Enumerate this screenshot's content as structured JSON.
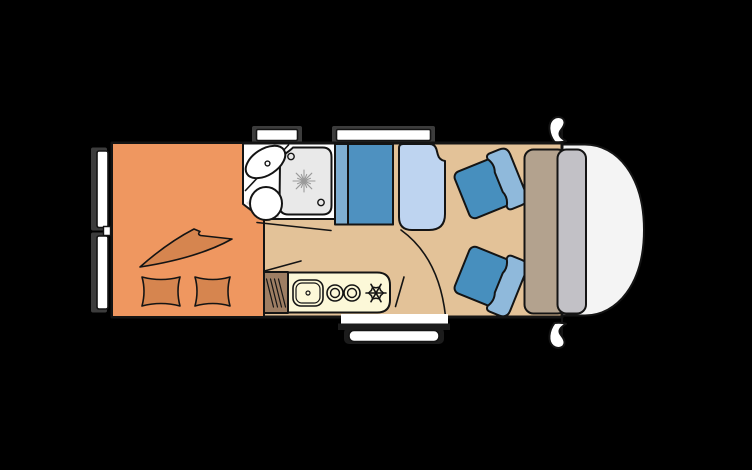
{
  "page": {
    "title": "Motorhome floor plan",
    "description": "Top-down layout diagram of a camper van interior"
  },
  "colors": {
    "background": "#000000",
    "line": "#141414",
    "floor": "#e3c298",
    "bed": "#ef9760",
    "bedding": "#d6854f",
    "bathroom": "#ffffff",
    "bathroom_shade": "#dcdcdc",
    "shower_tray": "#e9e9e9",
    "drain": "#9a9a9a",
    "bench_seat": "#4e91c0",
    "bench_back": "#7fafd2",
    "side_seat": "#bed4f0",
    "kitchen_counter": "#fcf8d8",
    "cabinet": "#9e7e63",
    "chair_seat": "#478fbe",
    "chair_back": "#8fb9db",
    "dashboard": "#b3a28e",
    "windshield_band": "#c2c1c6",
    "cab_nose": "#f4f4f4",
    "window_glass": "#ffffff",
    "window_frame": "#3c3c3c",
    "step": "#ffffff",
    "step_shadow": "#1c1c1c"
  },
  "icons": {
    "fridge": "snowflake-icon",
    "shower_drain": "starburst-icon",
    "hobs": "double-ring-burner-icons",
    "heater_vent": "hatched-lines-icon"
  },
  "parts": {
    "rear_bed": "rear transverse bed with blanket and two pillows",
    "bathroom": "washroom with corner basin, toilet and shower tray",
    "dinette": "forward-facing bench seat with backrest",
    "side_seat": "side seat / bed extension",
    "kitchen": "kitchen block with sink, two burners and fridge",
    "cabinet": "heater / vent cabinet",
    "cab": "driver cab with two swivel chairs, dashboard and windscreen nose",
    "openings": "two roof/side windows top, two windows rear left, entry door with step bottom, two side mirrors"
  }
}
